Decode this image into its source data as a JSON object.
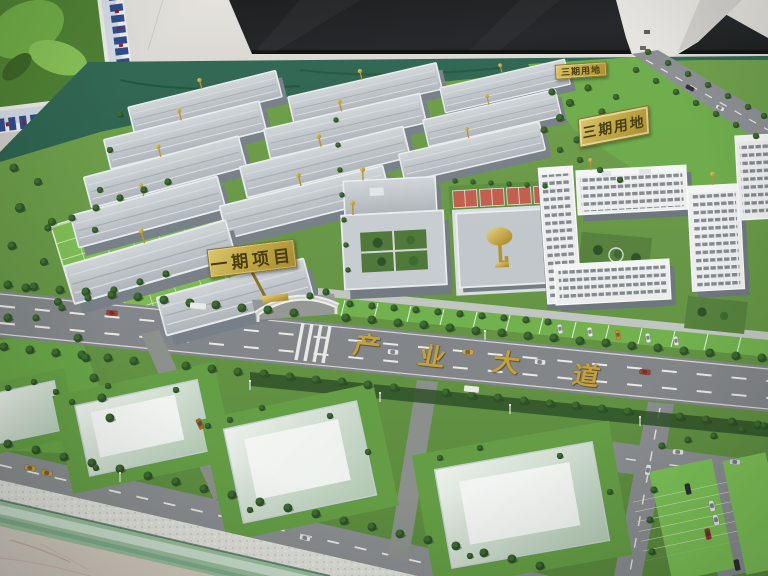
{
  "signs": {
    "phase1_project": "一期项目",
    "phase3_small": "三期用地",
    "phase3_plaque": "三期用地"
  },
  "road": {
    "name_chars": [
      "产",
      "业",
      "大",
      "道"
    ],
    "name_full": "产业大道"
  },
  "colors": {
    "gold": "#c9a43c",
    "lawn_green": "#6b9c47",
    "bright_lawn": "#7fbf52",
    "felt_green": "#2a5c4a",
    "road_gray": "#8d9093",
    "roof_gray": "#c3c8cd",
    "building_white": "#f2f3f4",
    "screen_black": "#1b1c1e",
    "marble_floor": "#d8cfc5",
    "glass_edge": "#bcd8c4"
  }
}
